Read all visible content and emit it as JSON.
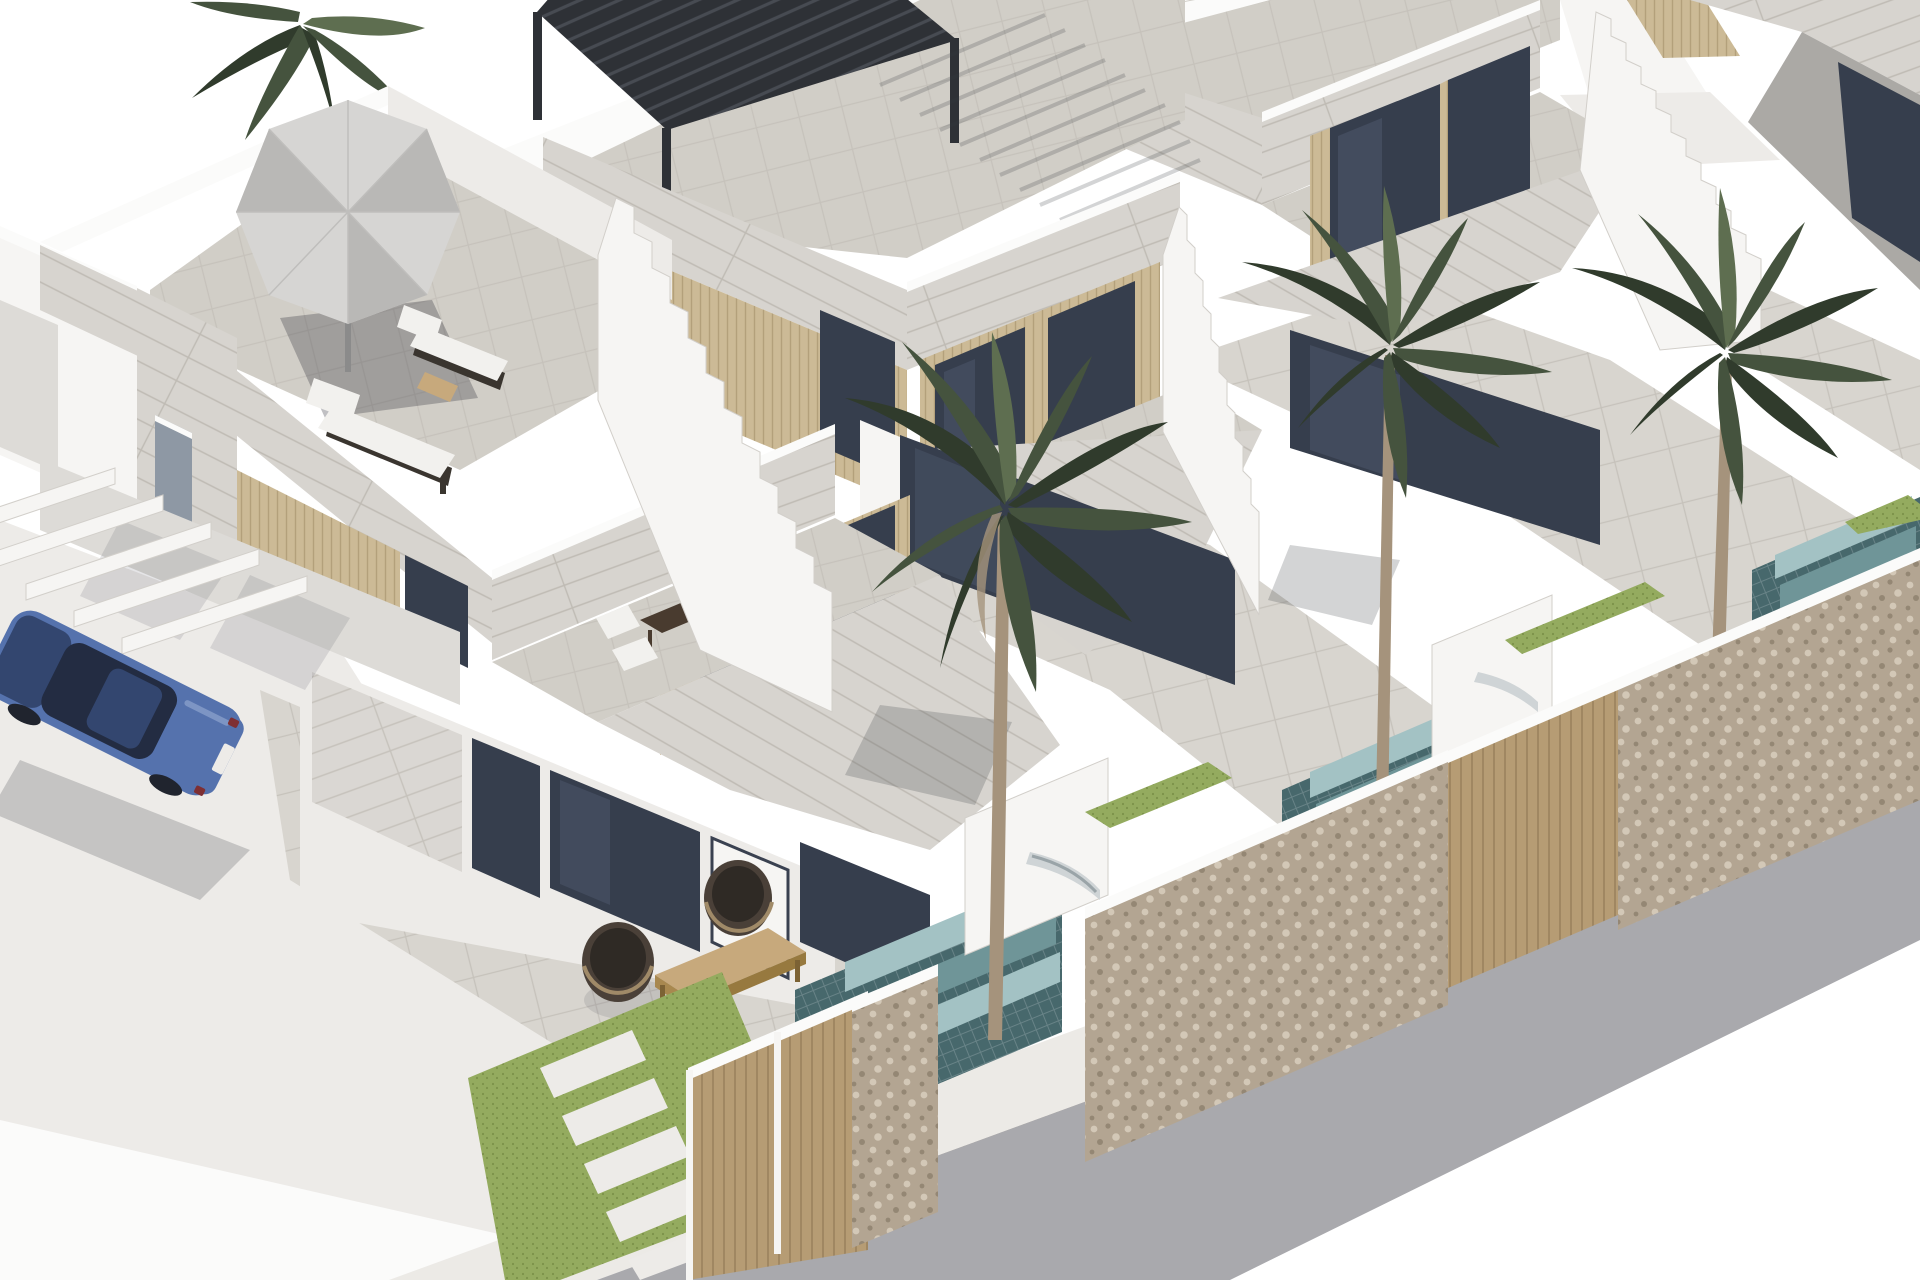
{
  "scene": {
    "kind": "architectural-3d-render",
    "subject": "Row of modern white two-storey townhouses with roof terraces, private plunge pools, palm trees, stone boundary walls, timber gates, a parked blue sedan and a street with kerb and gravel verge",
    "objects": [
      "roof-terrace-with-parasol-and-sun-loungers",
      "black-louvered-pergola",
      "external-staircase",
      "palm-tree",
      "plunge-pool-with-tiled-steps",
      "stone-boundary-wall",
      "timber-slat-gate",
      "lawn-with-paver-path",
      "blue-sedan",
      "street-with-kerb"
    ]
  },
  "colors": {
    "sky": "#ffffff",
    "wall_white": "#f6f5f3",
    "wall_light": "#edebe8",
    "wall_shade": "#dddbd7",
    "wall_dark": "#c9c7c3",
    "soffit_gray": "#aba9a5",
    "stone_fascia": "#d7d4cf",
    "stone_line": "#bfbbb4",
    "paver": "#d8d5cf",
    "paver_line": "#c6c2bb",
    "roof_paver": "#d1cec7",
    "glass_dark": "#363e4d",
    "glass_mid": "#4e586d",
    "glass_light": "#77819a",
    "glass_pale": "#8e98a4",
    "wood_slat": "#ccba96",
    "wood_slat_line": "#b3a07b",
    "gate_wood": "#b69c74",
    "gate_wood_line": "#9a825e",
    "stone_wall": "#b3a592",
    "stone_speck_light": "#d3c8b7",
    "stone_speck_dark": "#948774",
    "pool_dark": "#47686c",
    "pool_mid": "#6f9598",
    "pool_light": "#a3c2c4",
    "pool_grid": "#ffffff",
    "grass": "#94ab5f",
    "grass_dark": "#7c9249",
    "road": "#a9a9ad",
    "curb": "#eceae6",
    "gravel": "#b9afa0",
    "gravel_dot": "#a39886",
    "car_blue": "#5572ad",
    "car_dark": "#33466f",
    "car_glass": "#232c42",
    "car_light": "#7d95c4",
    "pergola_dark": "#2e3136",
    "pergola_light": "#474b52",
    "umbrella": "#d6d5d3",
    "umbrella_shade": "#b9b8b6",
    "lounger_dark": "#3a352f",
    "cushion": "#f2f1ee",
    "table_wood": "#c7a97c",
    "table_dark": "#493b2f",
    "trunk": "#a5937c",
    "palm_green": "#45533e",
    "palm_dark": "#303b2c",
    "palm_light": "#5e6e50",
    "shadow_soft": "rgba(70,72,82,0.14)",
    "shadow_mid": "rgba(55,58,66,0.22)",
    "shadow_dark": "rgba(45,48,55,0.30)",
    "white_fg": "#fbfbfa"
  }
}
